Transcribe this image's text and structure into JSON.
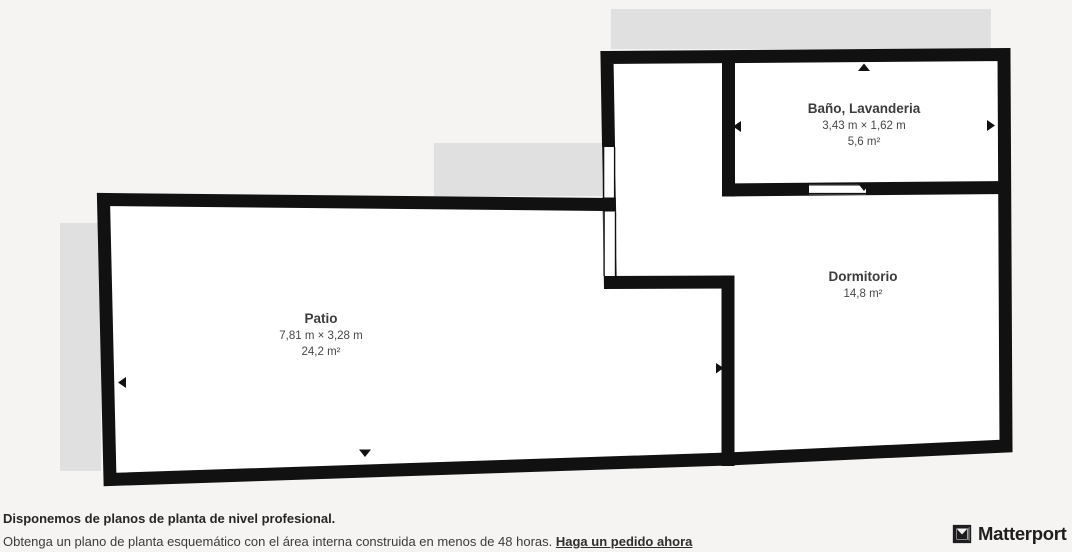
{
  "plan": {
    "rooms": [
      {
        "name": "Baño, Lavanderia",
        "dimensions": "3,43 m × 1,62 m",
        "area": "5,6 m²"
      },
      {
        "name": "Dormitorio",
        "area": "14,8 m²"
      },
      {
        "name": "Patio",
        "dimensions": "7,81 m × 3,28 m",
        "area": "24,2 m²"
      }
    ],
    "colors": {
      "background": "#f5f4f2",
      "wall": "#111111",
      "room_fill": "#ffffff",
      "exterior_shadow": "#e0e0e0",
      "label_text": "#3c3c3c"
    },
    "icons": {
      "dimension_arrow": "small black triangle marker"
    }
  },
  "footer": {
    "headline": "Disponemos de planos de planta de nivel profesional.",
    "body": "Obtenga un plano de planta esquemático con el área interna construida en menos de 48 horas. ",
    "link_label": "Haga un pedido ahora"
  },
  "brand": {
    "logo_text": "Matterport",
    "logo_icon": "matterport-m-cube"
  }
}
